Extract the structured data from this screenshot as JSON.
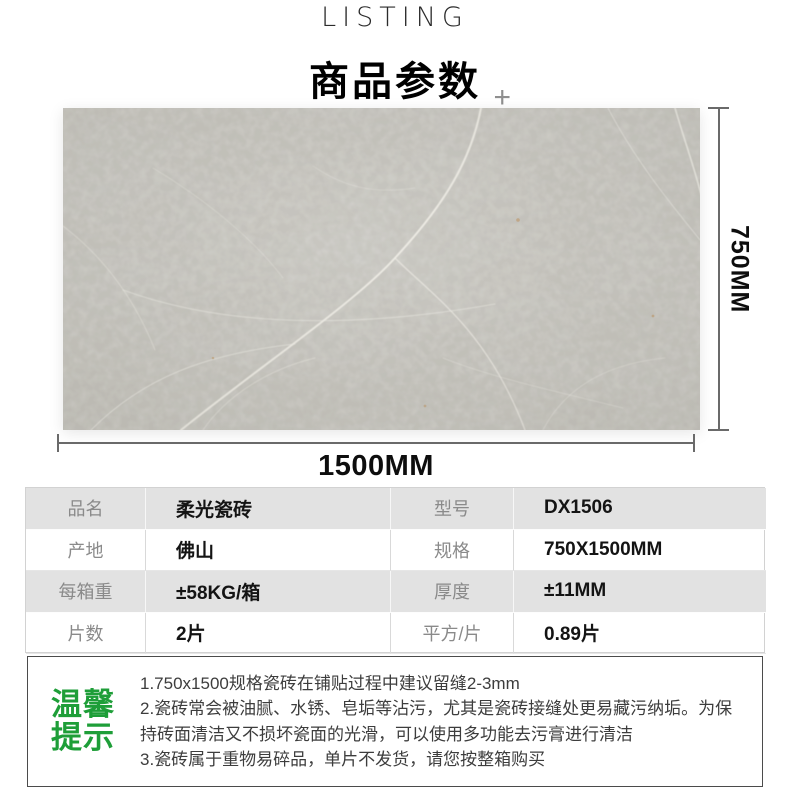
{
  "header": {
    "eyebrow": "LISTING",
    "title": "商品参数",
    "plus_glyph": "+"
  },
  "product_visual": {
    "tile_description": "gray-marble-soft-light-tile",
    "tile_base_color": "#c1bfb8",
    "vein_color": "#efede6",
    "height_label": "750MM",
    "width_label": "1500MM",
    "dimension_line_color": "#6a6a6a"
  },
  "spec_table": {
    "rows": [
      {
        "label1": "品名",
        "value1": "柔光瓷砖",
        "label2": "型号",
        "value2": "DX1506"
      },
      {
        "label1": "产地",
        "value1": "佛山",
        "label2": "规格",
        "value2": "750X1500MM"
      },
      {
        "label1": "每箱重",
        "value1": "±58KG/箱",
        "label2": "厚度",
        "value2": "±11MM"
      },
      {
        "label1": "片数",
        "value1": "2片",
        "label2": "平方/片",
        "value2": "0.89片"
      }
    ],
    "alt_row_color": "#e2e2e2",
    "label_text_color": "#8a8a8a",
    "value_text_color": "#141414"
  },
  "tips": {
    "heading_line1": "温馨",
    "heading_line2": "提示",
    "accent_color": "#1e9e38",
    "items": [
      "1.750x1500规格瓷砖在铺贴过程中建议留缝2-3mm",
      "2.瓷砖常会被油腻、水锈、皂垢等沾污，尤其是瓷砖接缝处更易藏污纳垢。为保持砖面清洁又不损坏瓷面的光滑，可以使用多功能去污膏进行清洁",
      "3.瓷砖属于重物易碎品，单片不发货，请您按整箱购买"
    ]
  }
}
